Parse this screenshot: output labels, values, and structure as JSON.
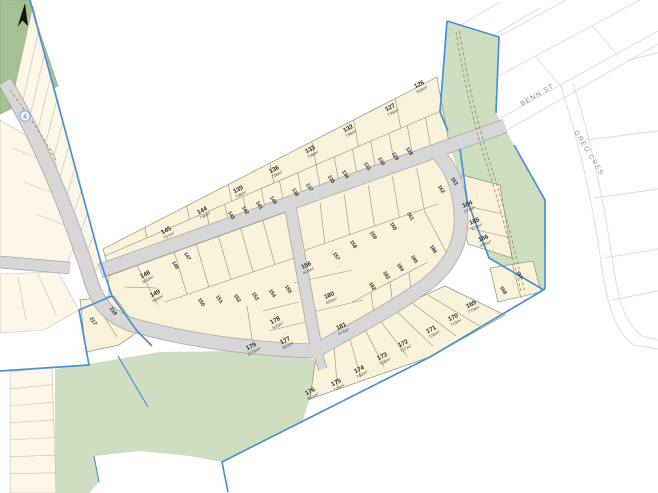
{
  "map": {
    "type": "subdivision-plat-plan",
    "marker_label": "4",
    "north_arrow": "north"
  },
  "streets": [
    {
      "name": "BENN ST"
    },
    {
      "name": "GREG CRES"
    }
  ],
  "colors": {
    "boundary_blue": "#4a90d8",
    "road_gray": "#d7d7d7",
    "road_edge": "#a9a9a9",
    "reserve_green_light": "#cddec1",
    "reserve_green_dark": "#a4c194",
    "new_lot_fill": "#faf2d8",
    "existing_lot_fill": "#fcf6e7",
    "track_dash_brown": "#a08f63"
  },
  "lots": [
    {
      "num": "126",
      "area": "634m²",
      "x": 420,
      "y": 86,
      "r": -28
    },
    {
      "num": "127",
      "area": "739m²",
      "x": 391,
      "y": 109,
      "r": -28
    },
    {
      "num": "132",
      "area": "739m²",
      "x": 349,
      "y": 130,
      "r": -28
    },
    {
      "num": "133",
      "area": "738m²",
      "x": 311,
      "y": 151,
      "r": -28
    },
    {
      "num": "136",
      "area": "738m²",
      "x": 275,
      "y": 171,
      "r": -28
    },
    {
      "num": "139",
      "area": "738m²",
      "x": 239,
      "y": 191,
      "r": -28
    },
    {
      "num": "144",
      "area": "738m²",
      "x": 203,
      "y": 212,
      "r": -28
    },
    {
      "num": "145",
      "area": "757m²",
      "x": 167,
      "y": 232,
      "r": -28
    },
    {
      "num": "148",
      "area": "600m²",
      "x": 146,
      "y": 276,
      "r": -28
    },
    {
      "num": "149",
      "area": "600m²",
      "x": 156,
      "y": 295,
      "r": -28
    },
    {
      "num": "156",
      "area": "600m²",
      "x": 307,
      "y": 267,
      "r": -25
    },
    {
      "num": "180",
      "area": "600m²",
      "x": 330,
      "y": 297,
      "r": -25
    },
    {
      "num": "181",
      "area": "574m²",
      "x": 342,
      "y": 328,
      "r": -25
    },
    {
      "num": "164",
      "area": "374m²",
      "x": 468,
      "y": 206,
      "r": -22
    },
    {
      "num": "165",
      "area": "374m²",
      "x": 475,
      "y": 223,
      "r": -22
    },
    {
      "num": "166",
      "area": "376m²",
      "x": 484,
      "y": 240,
      "r": -22
    },
    {
      "num": "169",
      "area": "779m²",
      "x": 472,
      "y": 306,
      "r": -28
    },
    {
      "num": "170",
      "area": "723m²",
      "x": 454,
      "y": 319,
      "r": -28
    },
    {
      "num": "171",
      "area": "728m²",
      "x": 432,
      "y": 331,
      "r": -28
    },
    {
      "num": "172",
      "area": "727m²",
      "x": 404,
      "y": 345,
      "r": -28
    },
    {
      "num": "173",
      "area": "728m²",
      "x": 383,
      "y": 358,
      "r": -28
    },
    {
      "num": "174",
      "area": "740m²",
      "x": 360,
      "y": 371,
      "r": -28
    },
    {
      "num": "175",
      "area": "718m²",
      "x": 337,
      "y": 384,
      "r": -28
    },
    {
      "num": "176",
      "area": "802m²",
      "x": 311,
      "y": 393,
      "r": -28
    },
    {
      "num": "177",
      "area": "600m²",
      "x": 286,
      "y": 342,
      "r": -28
    },
    {
      "num": "178",
      "area": "620m²",
      "x": 276,
      "y": 322,
      "r": -28
    },
    {
      "num": "179",
      "area": "1078m²",
      "x": 252,
      "y": 348,
      "r": -28
    },
    {
      "num": "128",
      "x": 408,
      "y": 152,
      "r": 58
    },
    {
      "num": "129",
      "x": 394,
      "y": 157,
      "r": 58
    },
    {
      "num": "130",
      "x": 380,
      "y": 162,
      "r": 58
    },
    {
      "num": "131",
      "x": 366,
      "y": 167,
      "r": 58
    },
    {
      "num": "134",
      "x": 344,
      "y": 175,
      "r": 58
    },
    {
      "num": "135",
      "x": 330,
      "y": 180,
      "r": 58
    },
    {
      "num": "137",
      "x": 308,
      "y": 188,
      "r": 58
    },
    {
      "num": "138",
      "x": 294,
      "y": 193,
      "r": 58
    },
    {
      "num": "140",
      "x": 272,
      "y": 201,
      "r": 58
    },
    {
      "num": "141",
      "x": 258,
      "y": 206,
      "r": 58
    },
    {
      "num": "142",
      "x": 244,
      "y": 211,
      "r": 58
    },
    {
      "num": "143",
      "x": 230,
      "y": 216,
      "r": 58
    },
    {
      "num": "146",
      "x": 174,
      "y": 266,
      "r": 58
    },
    {
      "num": "147",
      "x": 186,
      "y": 257,
      "r": 58
    },
    {
      "num": "150",
      "x": 200,
      "y": 303,
      "r": 58
    },
    {
      "num": "151",
      "x": 218,
      "y": 300,
      "r": 58
    },
    {
      "num": "152",
      "x": 236,
      "y": 299,
      "r": 58
    },
    {
      "num": "153",
      "x": 254,
      "y": 297,
      "r": 58
    },
    {
      "num": "154",
      "x": 271,
      "y": 294,
      "r": 58
    },
    {
      "num": "155",
      "x": 287,
      "y": 290,
      "r": 58
    },
    {
      "num": "157",
      "x": 335,
      "y": 257,
      "r": 58
    },
    {
      "num": "158",
      "x": 352,
      "y": 245,
      "r": 58
    },
    {
      "num": "159",
      "x": 372,
      "y": 236,
      "r": 58
    },
    {
      "num": "160",
      "x": 392,
      "y": 227,
      "r": 58
    },
    {
      "num": "161",
      "x": 409,
      "y": 217,
      "r": 58
    },
    {
      "num": "162",
      "x": 440,
      "y": 190,
      "r": 58
    },
    {
      "num": "163",
      "x": 453,
      "y": 182,
      "r": 58
    },
    {
      "num": "182",
      "x": 371,
      "y": 287,
      "r": 58
    },
    {
      "num": "183",
      "x": 385,
      "y": 276,
      "r": 58
    },
    {
      "num": "184",
      "x": 399,
      "y": 268,
      "r": 58
    },
    {
      "num": "185",
      "x": 413,
      "y": 260,
      "r": 58
    },
    {
      "num": "186",
      "x": 432,
      "y": 250,
      "r": 58
    },
    {
      "num": "167",
      "x": 518,
      "y": 276,
      "r": 58
    },
    {
      "num": "168",
      "x": 502,
      "y": 291,
      "r": 58
    },
    {
      "num": "217",
      "x": 92,
      "y": 322,
      "r": 55
    },
    {
      "num": "218",
      "x": 112,
      "y": 312,
      "r": 55
    }
  ]
}
